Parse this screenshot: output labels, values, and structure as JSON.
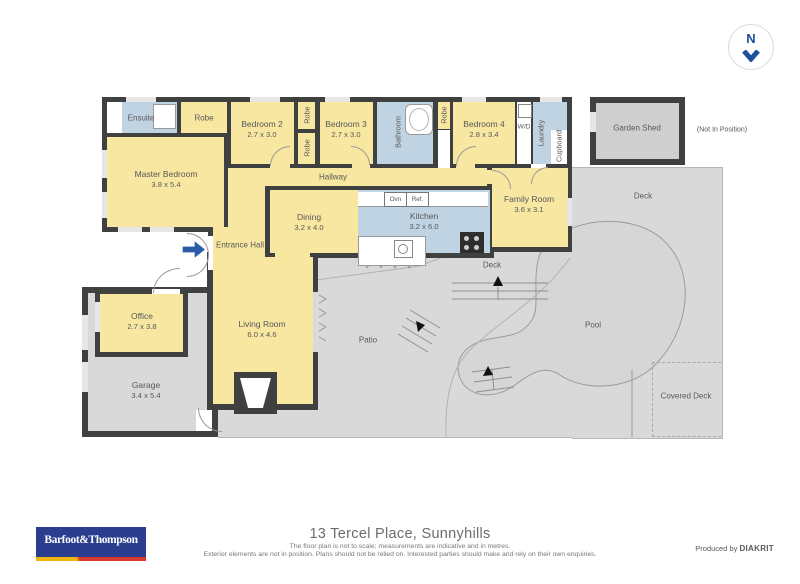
{
  "compass": {
    "letter": "N"
  },
  "plan": {
    "rooms": {
      "ensuite": {
        "label": "Ensuite"
      },
      "robe_top": {
        "label": "Robe"
      },
      "bedroom2": {
        "label": "Bedroom 2",
        "dims": "2.7 x 3.0"
      },
      "robe_a": {
        "label": "Robe"
      },
      "robe_b": {
        "label": "Robe"
      },
      "bedroom3": {
        "label": "Bedroom 3",
        "dims": "2.7 x 3.0"
      },
      "bathroom": {
        "label": "Bathroom"
      },
      "robe_c": {
        "label": "Robe"
      },
      "bedroom4": {
        "label": "Bedroom 4",
        "dims": "2.8 x 3.4"
      },
      "wd": {
        "label": "W/D"
      },
      "laundry": {
        "label": "Laundry"
      },
      "cupboard": {
        "label": "Cupboard"
      },
      "garden_shed": {
        "label": "Garden Shed"
      },
      "master_bedroom": {
        "label": "Master Bedroom",
        "dims": "3.8 x 5.4"
      },
      "hallway": {
        "label": "Hallway"
      },
      "family_room": {
        "label": "Family Room",
        "dims": "3.6 x 3.1"
      },
      "kitchen": {
        "label": "Kitchen",
        "dims": "3.2 x 6.0"
      },
      "dining": {
        "label": "Dining",
        "dims": "3.2 x 4.0"
      },
      "entrance_hall": {
        "label": "Entrance Hall"
      },
      "office": {
        "label": "Office",
        "dims": "2.7 x 3.8"
      },
      "living_room": {
        "label": "Living Room",
        "dims": "6.0 x 4.6"
      },
      "garage": {
        "label": "Garage",
        "dims": "3.4 x 5.4"
      },
      "deck_mid": {
        "label": "Deck"
      },
      "deck_right": {
        "label": "Deck"
      },
      "patio": {
        "label": "Patio"
      },
      "pool": {
        "label": "Pool"
      },
      "covered_deck": {
        "label": "Covered Deck"
      }
    },
    "appliances": {
      "oven": "Ovn",
      "fridge": "Ref."
    },
    "notes": {
      "not_in_position": "(Not In Position)"
    }
  },
  "footer": {
    "logo_text": "Barfoot&Thompson",
    "address": "13 Tercel Place, Sunnyhills",
    "disclaimer1": "The floor plan is not to scale; measurements are indicative and in metres.",
    "disclaimer2": "Exterior elements are not in position. Plans should not be relied on. Interested parties should make and rely on their own enquiries.",
    "produced_by_prefix": "Produced by ",
    "producer": "DIAKRIT"
  },
  "colors": {
    "wall": "#3f4040",
    "room_yellow": "#f8e7a1",
    "wet_area_blue": "#c0d3e2",
    "outdoor_gray": "#d9d9d9",
    "accent_navy": "#1d4f9c",
    "logo_navy": "#2a3d8f",
    "logo_red": "#d93a2f",
    "logo_yellow": "#f0b50a"
  }
}
